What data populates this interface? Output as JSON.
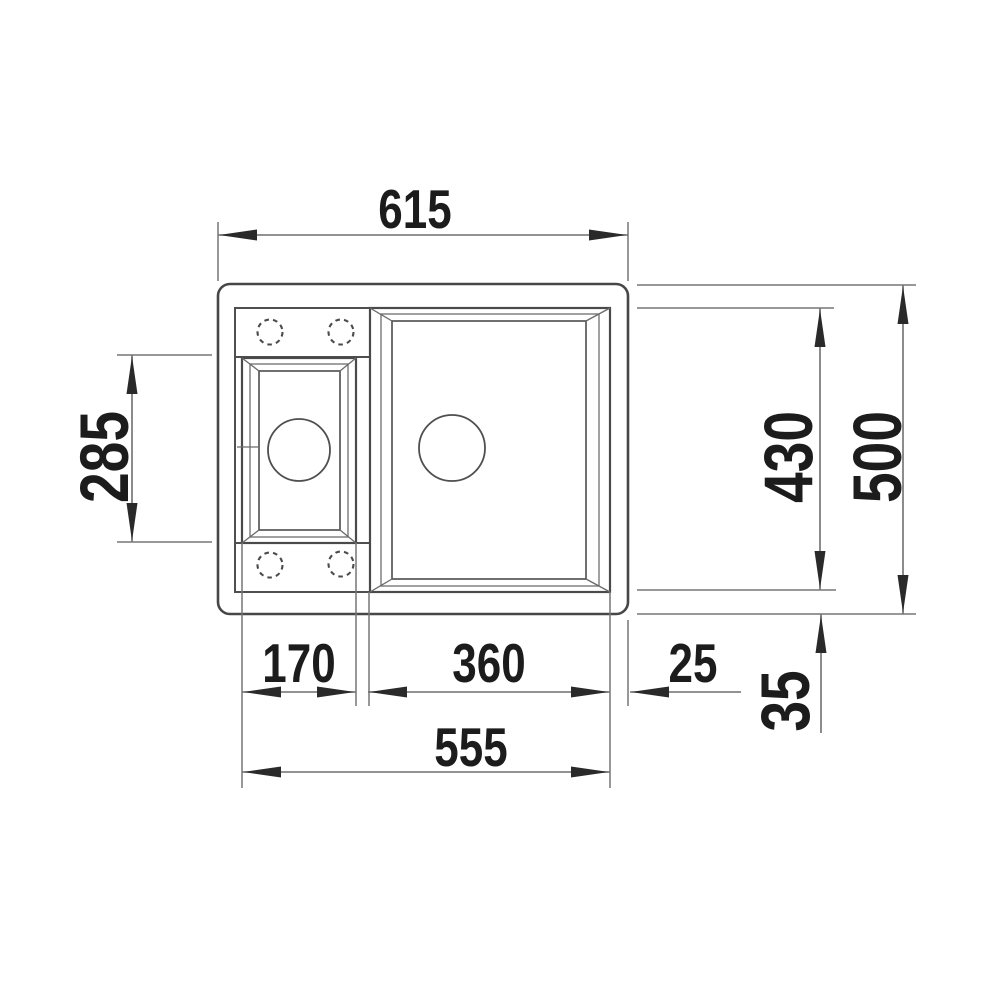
{
  "diagram": {
    "type": "technical-drawing",
    "subject": "kitchen sink top view with installation dimensions",
    "background_color": "#ffffff",
    "line_color": "#4a4a4a",
    "text_color": "#1c1c1c",
    "labels": {
      "width_top": "615",
      "height_left_small_basin": "285",
      "height_right_basin": "430",
      "height_right_total": "500",
      "width_small_basin": "170",
      "width_large_basin": "360",
      "gap_right": "25",
      "width_basins_total": "555",
      "margin_bottom_right": "35"
    }
  }
}
